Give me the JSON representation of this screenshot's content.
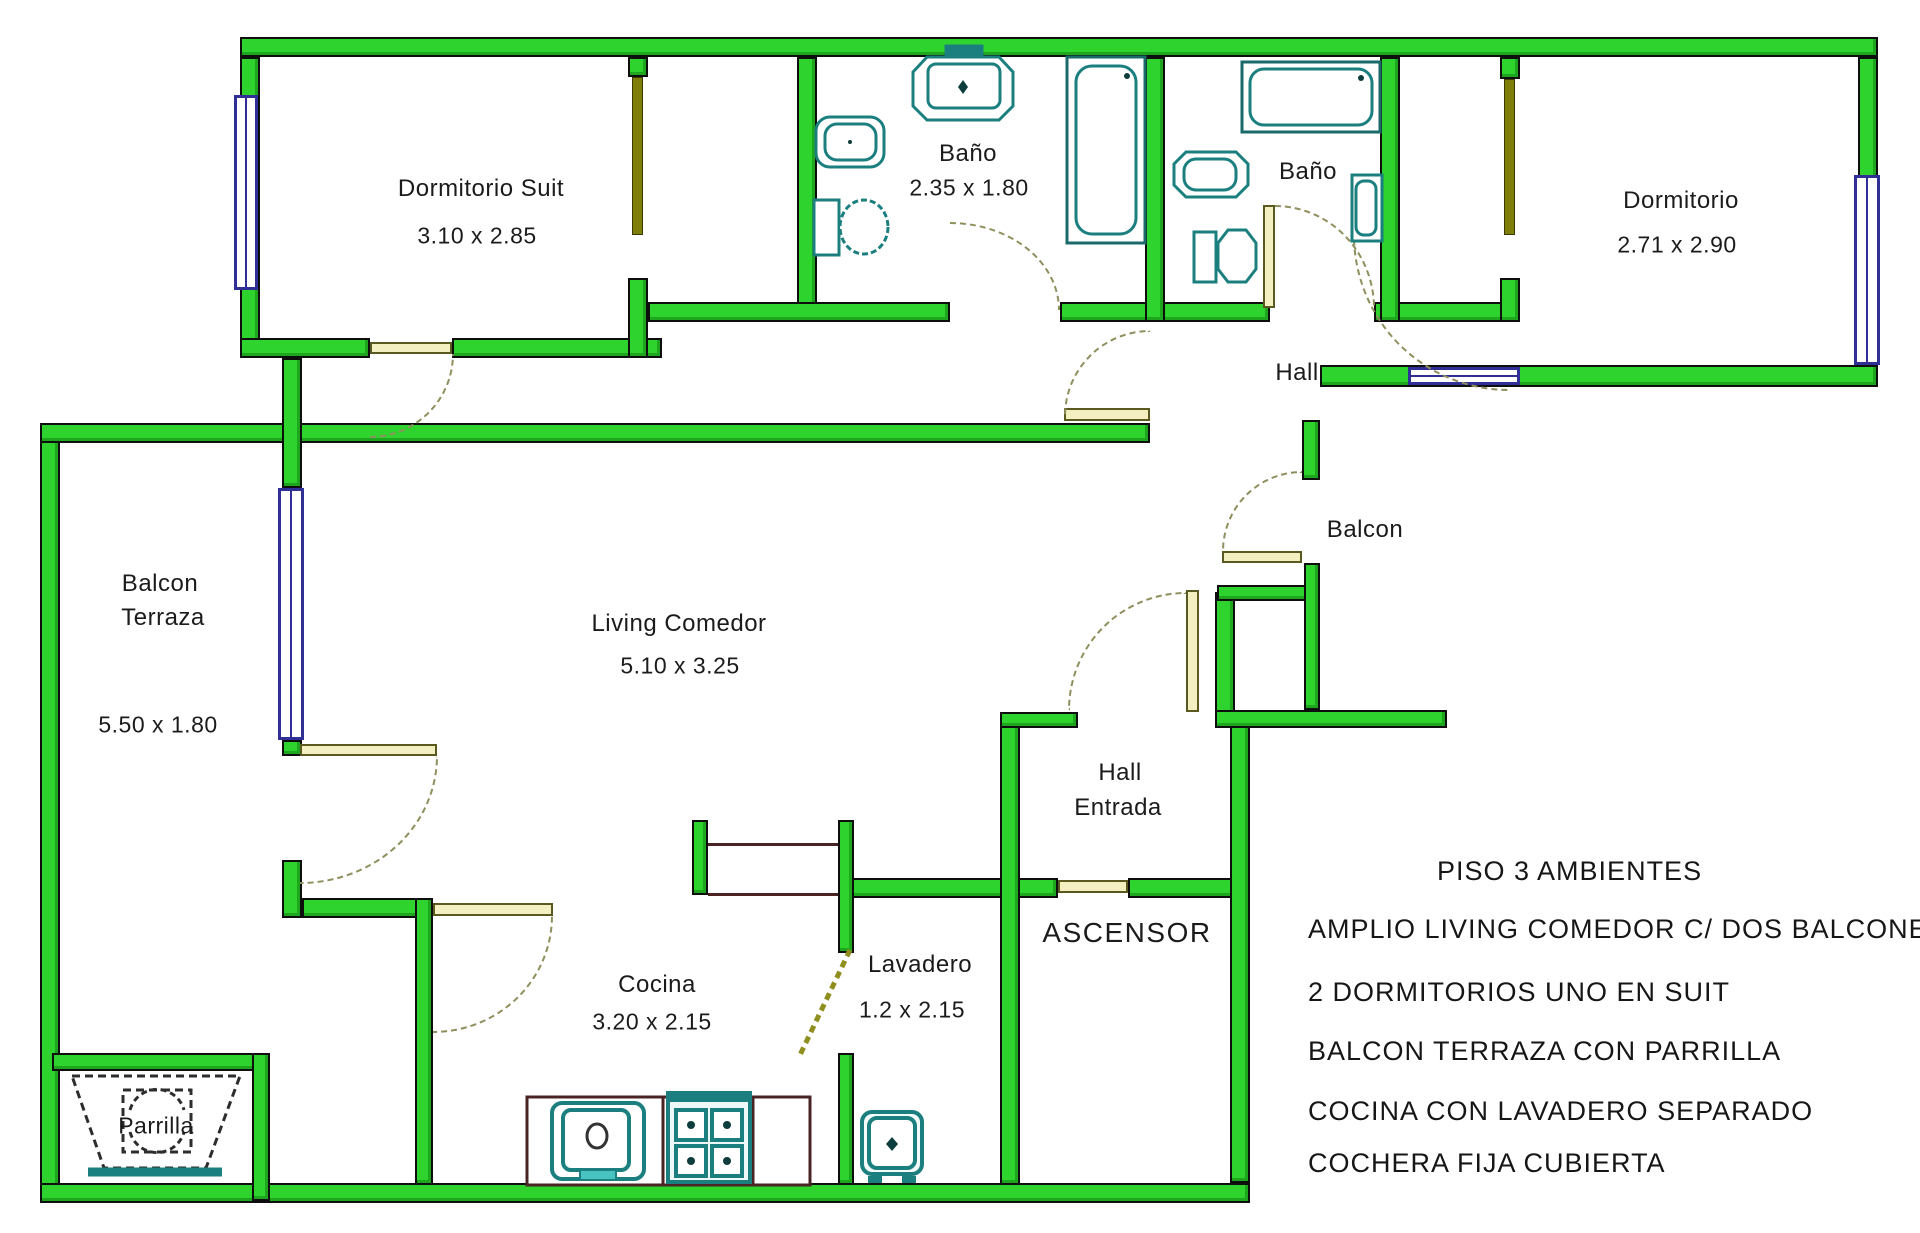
{
  "rooms": {
    "dormitorio_suit": {
      "label": "Dormitorio  Suit",
      "dims": "3.10 x 2.85"
    },
    "bano_suite": {
      "label": "Baño",
      "dims": "2.35  x  1.80"
    },
    "bano_2": {
      "label": "Baño"
    },
    "dormitorio": {
      "label": "Dormitorio",
      "dims": "2.71  x  2.90"
    },
    "hall": {
      "label": "Hall"
    },
    "balcon": {
      "label": "Balcon"
    },
    "balcon_terraza": {
      "label_line1": "Balcon",
      "label_line2": "Terraza",
      "dims": "5.50  x  1.80"
    },
    "living_comedor": {
      "label": "Living   Comedor",
      "dims": "5.10  x  3.25"
    },
    "hall_entrada": {
      "label_line1": "Hall",
      "label_line2": "Entrada"
    },
    "ascensor": {
      "label": "ASCENSOR"
    },
    "cocina": {
      "label": "Cocina",
      "dims": "3.20  x  2.15"
    },
    "lavadero": {
      "label": "Lavadero",
      "dims": "1.2  x  2.15"
    },
    "parrilla": {
      "label": "Parrilla"
    }
  },
  "notes": [
    "PISO  3  AMBIENTES",
    "AMPLIO LIVING COMEDOR C/  DOS BALCONES",
    "2 DORMITORIOS UNO EN SUIT",
    "BALCON  TERRAZA CON PARRILLA",
    "COCINA CON LAVADERO SEPARADO",
    "COCHERA FIJA CUBIERTA"
  ],
  "colors": {
    "wall": "#2ed32e",
    "outline": "#0e0e0e",
    "fixture": "#1b7f7f",
    "window": "#2f2f96",
    "door": "#7e7e08",
    "counter": "#4a2424",
    "text": "#1b1b1b"
  }
}
